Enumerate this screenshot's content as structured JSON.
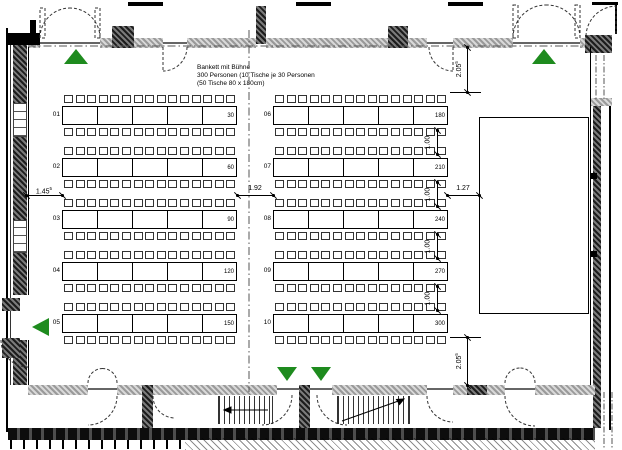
{
  "plan": {
    "title_lines": [
      "Bankett mit Bühne",
      "300 Personen (10 Tische je 30 Personen",
      "(50 Tische 80 x 180cm)"
    ]
  },
  "rows": {
    "left": [
      {
        "id": "01",
        "count": "30"
      },
      {
        "id": "02",
        "count": "60"
      },
      {
        "id": "03",
        "count": "90"
      },
      {
        "id": "04",
        "count": "120"
      },
      {
        "id": "05",
        "count": "150"
      }
    ],
    "right": [
      {
        "id": "06",
        "count": "180"
      },
      {
        "id": "07",
        "count": "210"
      },
      {
        "id": "08",
        "count": "240"
      },
      {
        "id": "09",
        "count": "270"
      },
      {
        "id": "10",
        "count": "300"
      }
    ]
  },
  "dimensions": {
    "left_gap": {
      "value": "1.45",
      "sup": "5"
    },
    "center_gap": {
      "value": "1.92",
      "sup": ""
    },
    "stage_gap": {
      "value": "1.27",
      "sup": ""
    },
    "top_offset": {
      "value": "2.05",
      "sup": "5"
    },
    "bottom_offset": {
      "value": "2.05",
      "sup": "5"
    },
    "row_gap": {
      "value": "1.00",
      "sup": ""
    }
  },
  "exits": [
    {
      "name": "exit-top-left",
      "direction": "up"
    },
    {
      "name": "exit-top-right",
      "direction": "up"
    },
    {
      "name": "exit-left",
      "direction": "left"
    },
    {
      "name": "exit-bottom-1",
      "direction": "down"
    },
    {
      "name": "exit-bottom-2",
      "direction": "down"
    }
  ],
  "colors": {
    "exit_green": "#1e8b1e",
    "line": "#000000"
  }
}
